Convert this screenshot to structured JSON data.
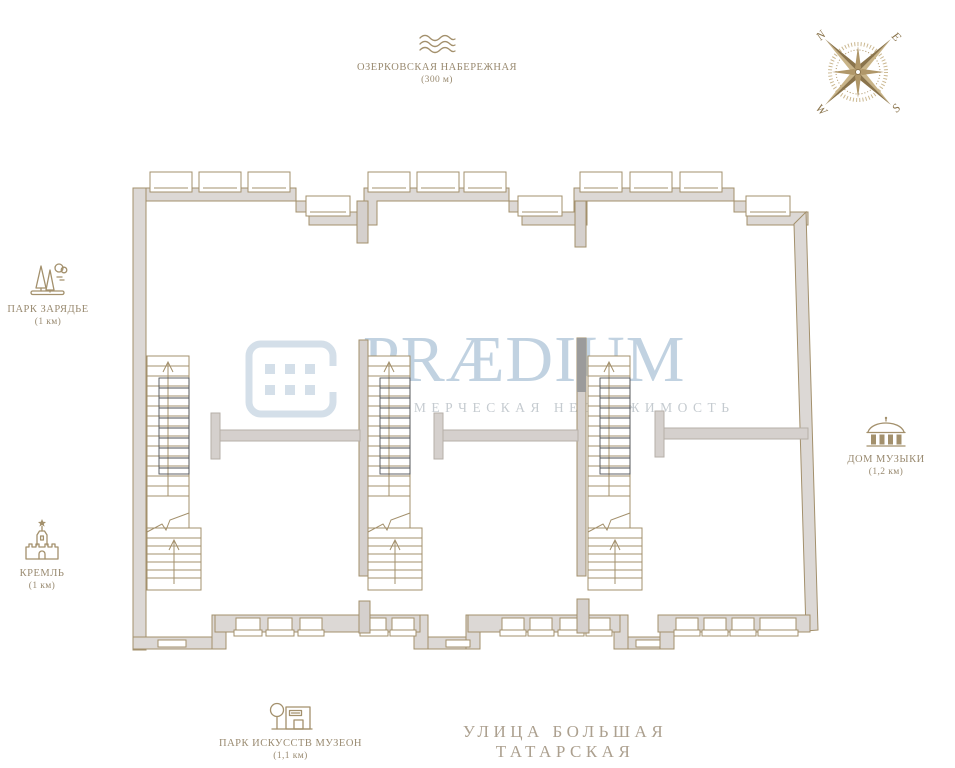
{
  "watermark": {
    "brand": "PRÆDIUM",
    "tagline": "КОММЕРЧЕСКАЯ НЕДВИЖИМОСТЬ"
  },
  "compass": {
    "n": "N",
    "e": "E",
    "s": "S",
    "w": "W"
  },
  "landmarks": {
    "embankment": {
      "name": "ОЗЕРКОВСКАЯ НАБЕРЕЖНАЯ",
      "distance": "(300 м)",
      "icon": "waves-icon"
    },
    "zaryadye": {
      "name": "ПАРК ЗАРЯДЬЕ",
      "distance": "(1 км)",
      "icon": "park-trees-icon"
    },
    "kremlin": {
      "name": "КРЕМЛЬ",
      "distance": "(1 км)",
      "icon": "kremlin-tower-icon"
    },
    "music": {
      "name": "ДОМ МУЗЫКИ",
      "distance": "(1,2 км)",
      "icon": "dome-building-icon"
    },
    "muzeon": {
      "name": "ПАРК ИСКУССТВ МУЗЕОН",
      "distance": "(1,1 км)",
      "icon": "park-museum-icon"
    }
  },
  "street": {
    "name": "УЛИЦА БОЛЬШАЯ ТАТАРСКАЯ"
  },
  "colors": {
    "wall_outline": "#a3906c",
    "wall_fill": "#dcd8d5",
    "interior_wall": "#d5d0cd",
    "dark_line": "#4e5257",
    "compass_tan": "#b09769",
    "compass_dark": "#8a744c",
    "watermark_blue": "#b2c8da",
    "watermark_tagline": "#c5cbd0",
    "label_text": "#998a70",
    "street_text": "#aca08f"
  }
}
